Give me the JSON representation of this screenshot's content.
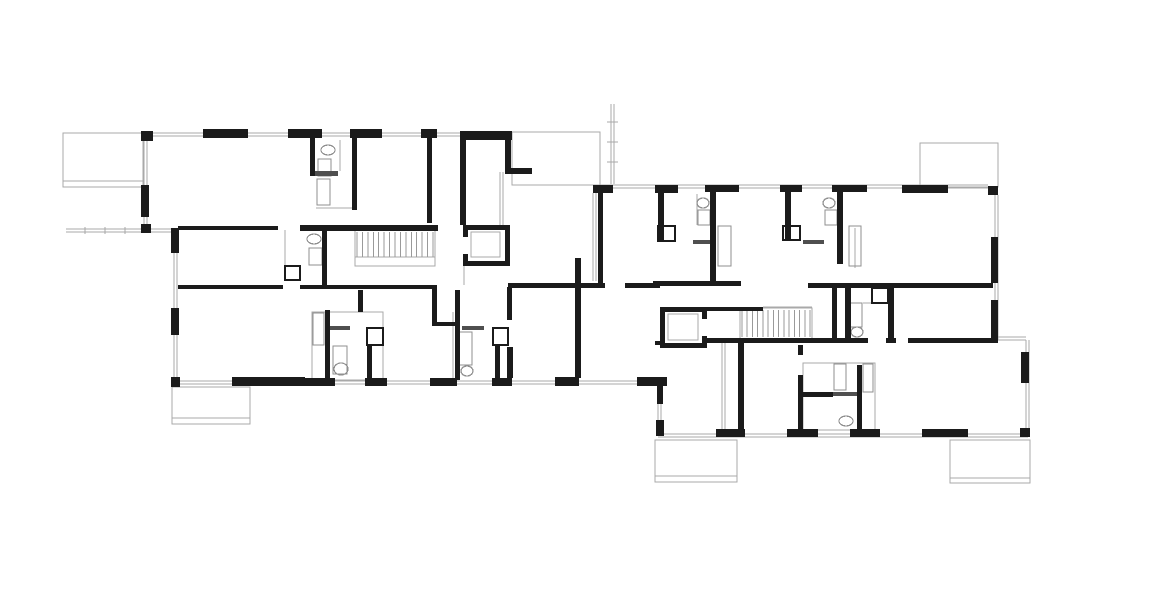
{
  "document": {
    "kind": "architectural-floor-plan",
    "description": "Black-and-white CAD floor plan of a two-wing residential building with two stair cores, two elevators, bathrooms and terraces. No text labels visible."
  },
  "plan": {
    "canvas": {
      "w": 1170,
      "h": 591
    },
    "colors": {
      "bg": "#ffffff",
      "wall": "#1b1b1b",
      "thin": "#a9a9a9",
      "medium": "#8f8f8f",
      "dark": "#4f4f4f",
      "hatch": "#9a9a9a"
    },
    "layers": [
      {
        "name": "terraces",
        "kind": "rect",
        "mode": "stroke",
        "color": "thin",
        "width": 1,
        "items": [
          [
            63,
            133,
            80,
            54
          ],
          [
            172,
            387,
            78,
            37
          ],
          [
            512,
            132,
            88,
            53
          ],
          [
            920,
            143,
            78,
            44
          ],
          [
            655,
            440,
            82,
            42
          ],
          [
            950,
            440,
            80,
            43
          ]
        ]
      },
      {
        "name": "terrace-edges",
        "kind": "line",
        "color": "thin",
        "width": 1,
        "items": [
          [
            63,
            181,
            143,
            181
          ],
          [
            172,
            418,
            250,
            418
          ],
          [
            655,
            476,
            737,
            476
          ],
          [
            950,
            478,
            1030,
            478
          ]
        ]
      },
      {
        "name": "facade-window-lines",
        "kind": "line",
        "color": "thin",
        "width": 1,
        "items": [
          [
            152,
            133,
            460,
            133
          ],
          [
            152,
            136,
            460,
            136
          ],
          [
            144,
            141,
            144,
            228
          ],
          [
            147,
            141,
            147,
            228
          ],
          [
            148,
            229,
            174,
            229
          ],
          [
            148,
            232,
            174,
            232
          ],
          [
            174,
            228,
            174,
            381
          ],
          [
            177,
            228,
            177,
            381
          ],
          [
            174,
            381,
            640,
            381
          ],
          [
            174,
            384,
            640,
            384
          ],
          [
            658,
            404,
            658,
            431
          ],
          [
            661,
            404,
            661,
            431
          ],
          [
            658,
            434,
            1028,
            434
          ],
          [
            658,
            437,
            1028,
            437
          ],
          [
            1026,
            340,
            1026,
            434
          ],
          [
            1029,
            340,
            1029,
            434
          ],
          [
            997,
            337,
            1026,
            337
          ],
          [
            997,
            340,
            1026,
            340
          ],
          [
            995,
            195,
            995,
            340
          ],
          [
            998,
            195,
            998,
            340
          ],
          [
            600,
            185,
            988,
            185
          ],
          [
            600,
            188,
            988,
            188
          ],
          [
            593,
            193,
            593,
            281
          ],
          [
            596,
            193,
            596,
            281
          ],
          [
            500,
            172,
            500,
            225
          ],
          [
            503,
            172,
            503,
            225
          ],
          [
            464,
            266,
            464,
            285
          ],
          [
            722,
            343,
            722,
            430
          ],
          [
            725,
            343,
            725,
            430
          ],
          [
            453,
            312,
            453,
            380
          ],
          [
            340,
            140,
            340,
            171
          ],
          [
            316,
            208,
            352,
            208
          ],
          [
            697,
            194,
            697,
            225
          ],
          [
            855,
            228,
            855,
            268
          ],
          [
            863,
            303,
            888,
            303
          ],
          [
            763,
            307,
            812,
            307
          ],
          [
            355,
            257,
            435,
            257
          ],
          [
            285,
            230,
            285,
            266
          ]
        ]
      },
      {
        "name": "garden-fence",
        "kind": "line",
        "color": "thin",
        "width": 1,
        "items": [
          [
            66,
            229,
            143,
            229
          ],
          [
            66,
            232,
            143,
            232
          ],
          [
            85,
            227,
            85,
            234
          ],
          [
            105,
            227,
            105,
            234
          ],
          [
            125,
            227,
            125,
            234
          ]
        ]
      },
      {
        "name": "balcony-railing",
        "kind": "line",
        "color": "thin",
        "width": 1,
        "items": [
          [
            611,
            104,
            611,
            184
          ],
          [
            614,
            104,
            614,
            184
          ],
          [
            607,
            122,
            618,
            122
          ],
          [
            607,
            142,
            618,
            142
          ],
          [
            607,
            162,
            618,
            162
          ]
        ]
      },
      {
        "name": "bath-outlines",
        "kind": "rect",
        "mode": "stroke",
        "color": "thin",
        "width": 1,
        "items": [
          [
            312,
            312,
            71,
            68
          ],
          [
            803,
            363,
            72,
            67
          ]
        ]
      },
      {
        "name": "stair-surrounds",
        "kind": "rect",
        "mode": "stroke",
        "color": "thin",
        "width": 1,
        "items": [
          [
            355,
            230,
            80,
            36
          ],
          [
            740,
            308,
            72,
            31
          ]
        ]
      },
      {
        "name": "elevator-cars",
        "kind": "rect",
        "mode": "stroke",
        "color": "thin",
        "width": 1.2,
        "items": [
          [
            471,
            232,
            29,
            25
          ],
          [
            668,
            314,
            30,
            26
          ]
        ]
      },
      {
        "name": "stair-hatching",
        "kind": "stairs",
        "color": "hatch",
        "width": 1,
        "items": [
          {
            "x": 357,
            "y": 232,
            "w": 76,
            "h": 25,
            "n": 14
          },
          {
            "x": 742,
            "y": 310,
            "w": 68,
            "h": 27,
            "n": 13
          }
        ]
      },
      {
        "name": "fixtures",
        "kind": "rect",
        "mode": "stroke",
        "color": "medium",
        "width": 1.2,
        "items": [
          [
            318,
            159,
            13,
            17
          ],
          [
            317,
            179,
            13,
            26
          ],
          [
            309,
            248,
            13,
            17
          ],
          [
            313,
            313,
            11,
            32
          ],
          [
            333,
            346,
            14,
            28
          ],
          [
            459,
            332,
            13,
            33
          ],
          [
            698,
            210,
            12,
            15
          ],
          [
            718,
            226,
            13,
            40
          ],
          [
            825,
            210,
            12,
            15
          ],
          [
            849,
            226,
            12,
            40
          ],
          [
            850,
            303,
            12,
            24
          ],
          [
            834,
            364,
            12,
            26
          ],
          [
            863,
            364,
            10,
            28
          ]
        ]
      },
      {
        "name": "toilets-sinks",
        "kind": "ellipse",
        "mode": "stroke",
        "color": "medium",
        "width": 1.2,
        "items": [
          [
            328,
            150,
            7,
            5
          ],
          [
            314,
            239,
            7,
            5
          ],
          [
            341,
            369,
            7,
            6
          ],
          [
            467,
            371,
            6,
            5
          ],
          [
            703,
            203,
            6,
            5
          ],
          [
            829,
            203,
            6,
            5
          ],
          [
            857,
            332,
            6,
            5
          ],
          [
            846,
            421,
            7,
            5
          ]
        ]
      },
      {
        "name": "door-thresholds",
        "kind": "rect",
        "mode": "fill",
        "color": "dark",
        "width": 0,
        "items": [
          [
            310,
            171,
            28,
            5
          ],
          [
            693,
            240,
            22,
            4
          ],
          [
            803,
            240,
            21,
            4
          ],
          [
            330,
            326,
            20,
            4
          ],
          [
            462,
            326,
            22,
            4
          ],
          [
            833,
            392,
            24,
            4
          ]
        ]
      },
      {
        "name": "walls",
        "kind": "rect",
        "mode": "fill",
        "color": "wall",
        "width": 0,
        "items": [
          [
            141,
            131,
            12,
            10
          ],
          [
            203,
            129,
            45,
            9
          ],
          [
            288,
            129,
            34,
            9
          ],
          [
            350,
            129,
            32,
            9
          ],
          [
            421,
            129,
            16,
            9
          ],
          [
            460,
            131,
            52,
            9
          ],
          [
            141,
            185,
            8,
            32
          ],
          [
            141,
            224,
            10,
            9
          ],
          [
            171,
            228,
            8,
            25
          ],
          [
            171,
            308,
            8,
            27
          ],
          [
            171,
            377,
            9,
            10
          ],
          [
            232,
            377,
            73,
            9
          ],
          [
            305,
            378,
            30,
            8
          ],
          [
            365,
            378,
            22,
            8
          ],
          [
            430,
            378,
            27,
            8
          ],
          [
            492,
            378,
            20,
            8
          ],
          [
            555,
            377,
            24,
            9
          ],
          [
            637,
            377,
            30,
            9
          ],
          [
            657,
            377,
            6,
            27
          ],
          [
            656,
            420,
            8,
            16
          ],
          [
            310,
            138,
            5,
            38
          ],
          [
            352,
            138,
            5,
            72
          ],
          [
            427,
            138,
            5,
            85
          ],
          [
            460,
            140,
            6,
            85
          ],
          [
            505,
            140,
            6,
            30
          ],
          [
            505,
            168,
            27,
            6
          ],
          [
            178,
            226,
            100,
            4
          ],
          [
            300,
            225,
            138,
            6
          ],
          [
            178,
            285,
            105,
            4
          ],
          [
            300,
            285,
            135,
            4
          ],
          [
            508,
            283,
            74,
            5
          ],
          [
            432,
            285,
            5,
            40
          ],
          [
            432,
            322,
            23,
            4
          ],
          [
            455,
            290,
            5,
            90
          ],
          [
            507,
            287,
            5,
            33
          ],
          [
            507,
            347,
            6,
            31
          ],
          [
            575,
            258,
            6,
            120
          ],
          [
            575,
            283,
            30,
            5
          ],
          [
            625,
            283,
            35,
            5
          ],
          [
            322,
            230,
            5,
            57
          ],
          [
            358,
            290,
            5,
            22
          ],
          [
            325,
            310,
            5,
            70
          ],
          [
            367,
            345,
            5,
            35
          ],
          [
            495,
            345,
            5,
            35
          ],
          [
            350,
            225,
            88,
            6
          ],
          [
            463,
            225,
            47,
            5
          ],
          [
            463,
            261,
            47,
            5
          ],
          [
            505,
            225,
            5,
            41
          ],
          [
            463,
            225,
            5,
            12
          ],
          [
            463,
            254,
            5,
            12
          ],
          [
            593,
            185,
            20,
            8
          ],
          [
            655,
            185,
            23,
            8
          ],
          [
            705,
            185,
            34,
            7
          ],
          [
            780,
            185,
            22,
            7
          ],
          [
            832,
            185,
            35,
            7
          ],
          [
            902,
            185,
            46,
            8
          ],
          [
            988,
            186,
            10,
            9
          ],
          [
            598,
            191,
            5,
            94
          ],
          [
            658,
            191,
            6,
            50
          ],
          [
            710,
            191,
            6,
            93
          ],
          [
            785,
            191,
            6,
            50
          ],
          [
            837,
            191,
            6,
            73
          ],
          [
            991,
            237,
            7,
            46
          ],
          [
            991,
            300,
            7,
            43
          ],
          [
            653,
            281,
            88,
            5
          ],
          [
            808,
            283,
            185,
            5
          ],
          [
            703,
            307,
            60,
            4
          ],
          [
            705,
            338,
            103,
            5
          ],
          [
            655,
            341,
            10,
            4
          ],
          [
            808,
            338,
            60,
            5
          ],
          [
            886,
            338,
            10,
            5
          ],
          [
            908,
            338,
            88,
            5
          ],
          [
            832,
            283,
            5,
            57
          ],
          [
            845,
            283,
            6,
            59
          ],
          [
            888,
            283,
            6,
            59
          ],
          [
            660,
            307,
            47,
            5
          ],
          [
            660,
            343,
            47,
            5
          ],
          [
            660,
            307,
            5,
            41
          ],
          [
            702,
            307,
            5,
            12
          ],
          [
            702,
            336,
            5,
            12
          ],
          [
            738,
            343,
            6,
            87
          ],
          [
            798,
            345,
            5,
            10
          ],
          [
            798,
            375,
            5,
            55
          ],
          [
            857,
            365,
            5,
            65
          ],
          [
            803,
            392,
            30,
            5
          ],
          [
            716,
            429,
            29,
            8
          ],
          [
            787,
            429,
            31,
            8
          ],
          [
            850,
            429,
            30,
            8
          ],
          [
            922,
            429,
            46,
            8
          ],
          [
            1020,
            428,
            10,
            9
          ],
          [
            1021,
            352,
            8,
            31
          ]
        ]
      },
      {
        "name": "closets",
        "kind": "rect",
        "mode": "stroke",
        "color": "wall",
        "width": 2.4,
        "items": [
          [
            658,
            226,
            17,
            15
          ],
          [
            783,
            226,
            17,
            14
          ],
          [
            367,
            328,
            16,
            17
          ],
          [
            493,
            328,
            15,
            17
          ],
          [
            285,
            266,
            15,
            14
          ],
          [
            872,
            288,
            16,
            15
          ]
        ]
      }
    ]
  }
}
